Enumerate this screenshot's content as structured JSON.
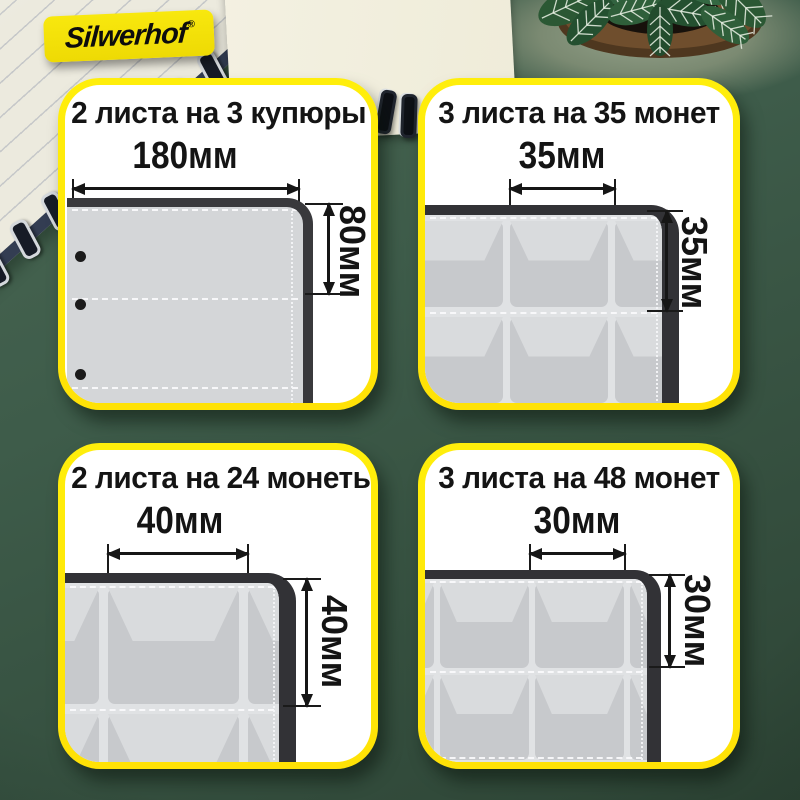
{
  "logo": {
    "text": "Silwerhof",
    "reg": "®"
  },
  "cards": [
    {
      "title": "2 листа на 3 купюры",
      "width_label": "180мм",
      "height_label": "80мм",
      "sheet_type": "banknote-sleeve"
    },
    {
      "title": "3 листа на 35 монет",
      "width_label": "35мм",
      "height_label": "35мм",
      "sheet_type": "coin-pockets"
    },
    {
      "title": "2 листа на 24 монеты",
      "width_label": "40мм",
      "height_label": "40мм",
      "sheet_type": "coin-pockets"
    },
    {
      "title": "3 листа на 48 монет",
      "width_label": "30мм",
      "height_label": "30мм",
      "sheet_type": "coin-pockets"
    }
  ],
  "colors": {
    "accent_yellow": "#ffe606",
    "card_background": "#ffffff",
    "text": "#141414",
    "desk_green": "#3a5545",
    "sheet_gray": "#d6d8da",
    "frame_dark": "#323236"
  }
}
